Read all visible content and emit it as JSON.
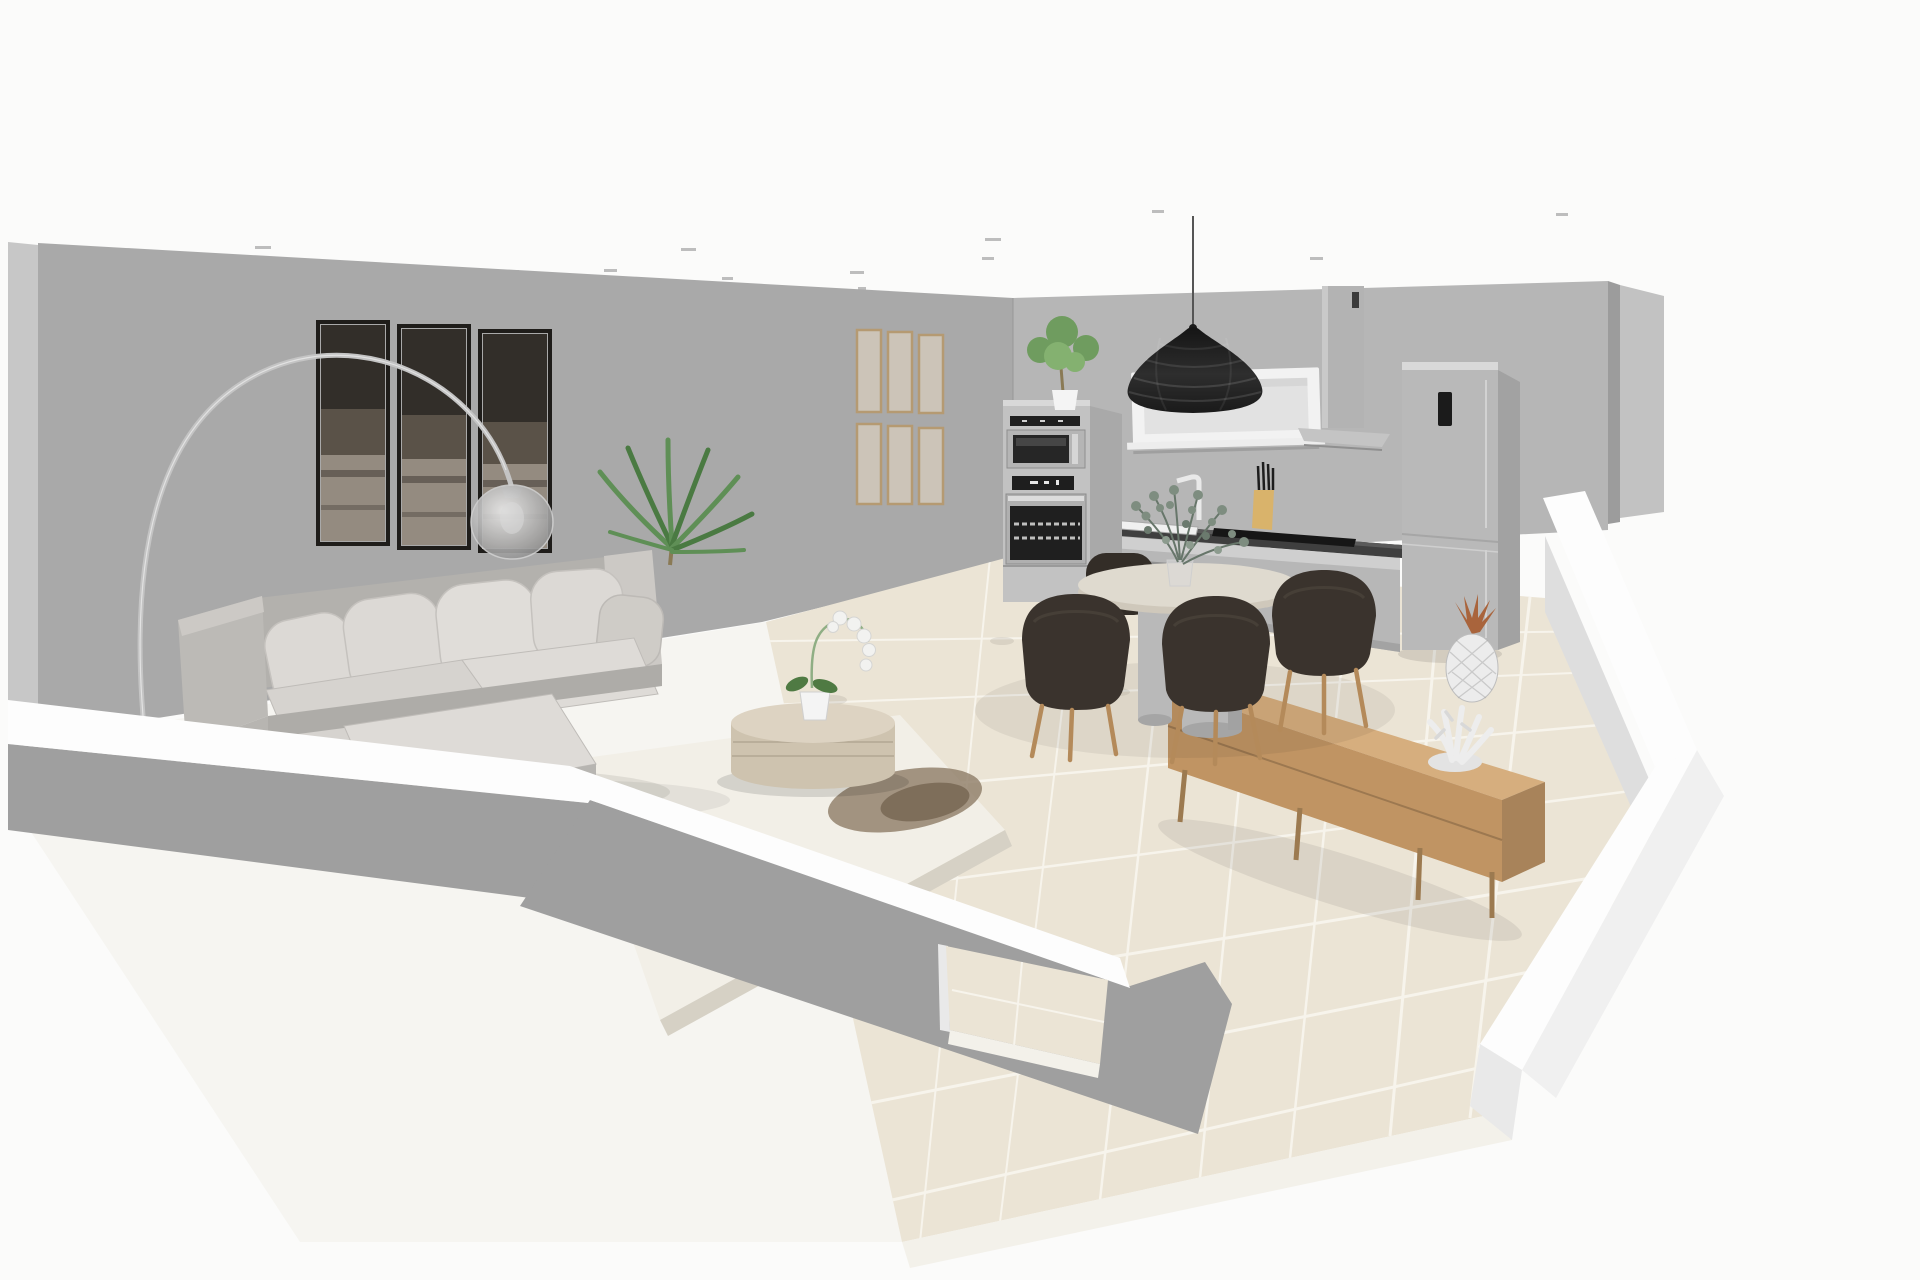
{
  "scene": {
    "view_label": "3D room plan view",
    "room_label": "Open plan living room and kitchen"
  },
  "palette": {
    "bg": "#fbfbfa",
    "wallMain": "#a9a9a9",
    "wallKitchen": "#b6b6b6",
    "wallEdgeLight": "#c7c7c7",
    "wallSideDark": "#9c9c9c",
    "wallFarLight": "#c2c2c2",
    "wallSeam": "#969696",
    "halfWallTop": "#fdfdfd",
    "halfWallFront": "#9f9f9f",
    "halfWallOuter": "#f0f0f0",
    "halfWallEnd": "#e9e9e9",
    "innerFace": "#dedede",
    "floorLiving": "#f6f5f1",
    "tile": "#ebe4d5",
    "grout": "#f7f4ec",
    "slabEdge": "#f3f1ea",
    "rug": "#f2efe7",
    "rugFringe": "#d6d1c5",
    "rugPatch": "#8d7c67",
    "rugPatchDark": "#6f5e4a",
    "sofaFrame": "#bcbab6",
    "sofaFrameDark": "#aeaca8",
    "sofaBack": "#b3b1ad",
    "sofaArmLight": "#ccc9c5",
    "sofaCushion": "#dcd9d5",
    "sofaCushionLight": "#e0ddd9",
    "sofaCushionDark": "#cfccc7",
    "sofaSeat": "#d6d3cf",
    "sofaChaise": "#dedbd7",
    "sofaFrontFace": "#b7b5b1",
    "artFrame": "#1f1d1a",
    "artTop": "#322e29",
    "artMid": "#5a5248",
    "artLow": "#948b80",
    "frameWood": "#b59a72",
    "frameInner": "#cdc5b8",
    "lampChrome": "#c4c4c4",
    "lampBase": "#d0d0d0",
    "lampCap": "#9a9a9a",
    "palmGreen": "#5f8f56",
    "palmGreenDark": "#4a7a42",
    "plantGreen": "#6f9c5f",
    "plantTrunk": "#8a7a55",
    "potWhite": "#f4f4f4",
    "drumTop": "#ddd3c2",
    "drumSide": "#cec3af",
    "drumBand": "#b9ae9a",
    "orchidWhite": "#f2f2f0",
    "orchidStem": "#8fae84",
    "leafGreen": "#4f7a43",
    "windowFrame": "#f2f2f2",
    "windowInner": "#e2e2e2",
    "windowSill": "#ededed",
    "hood": "#b3b3b3",
    "hoodCanopy": "#c4c4c4",
    "hoodSlot": "#3a3a3a",
    "steel": "#c2c2c2",
    "steelSide": "#a9a9a9",
    "steelTop": "#d8d8d8",
    "applianceBlack": "#1e1e1e",
    "applianceGlass": "#262626",
    "ovenGlass": "#1f1f1f",
    "ovenFrame": "#b0b0b0",
    "mwFrame": "#b5b5b5",
    "counterTop": "#3f3f3f",
    "cabinet": "#b7b7b7",
    "cabinetRail": "#cfcfcf",
    "cabinetPlinth": "#a3a3a3",
    "sinkWhite": "#f0f0f0",
    "hobBlack": "#161616",
    "knifeWood": "#d9b36b",
    "knifeDark": "#1d1d1d",
    "pendantDark": "#1c1c1c",
    "cord": "#555555",
    "tableTop": "#dfdacf",
    "tableRim": "#cfc8bb",
    "pedestal": "#b9b9b9",
    "chairDark": "#3a332d",
    "chairDark2": "#332d27",
    "chairSheen": "#4a423a",
    "legWood": "#b48a5a",
    "fridge": "#b9b9b9",
    "fridgeSide": "#a2a2a2",
    "fridgeTop": "#d9d9d9",
    "fridgePanel": "#1b1b1b",
    "fridgeSeam": "#a6a6a6",
    "sideboardTop": "#d6ae7e",
    "sideboardFront": "#c09463",
    "sideboardEnd": "#a8835a",
    "sideboardLeg": "#9c7a50",
    "pineapple": "#ececec",
    "pineappleLeaf": "#a9643c",
    "coral": "#ededed",
    "eucalyptus": "#7e8d80",
    "eucalyptusDark": "#67766a",
    "glassVase": "#d8d8d8",
    "ceilingLight": "#bdbdbd"
  },
  "objects": {
    "room": {
      "label": "open plan room"
    },
    "backWall": {
      "label": "back wall"
    },
    "kitchenWall": {
      "label": "kitchen wall"
    },
    "ceilingLights": {
      "label": "ceiling spotlights"
    },
    "wallArt": {
      "label": "triptych wall art"
    },
    "frameGrid": {
      "label": "gallery picture frames"
    },
    "arcLamp": {
      "label": "arc floor lamp"
    },
    "palm": {
      "label": "palm plant"
    },
    "sofa": {
      "label": "sectional sofa"
    },
    "rug": {
      "label": "area rug"
    },
    "coffeeTable": {
      "label": "round coffee table"
    },
    "orchid": {
      "label": "orchid in pot"
    },
    "tileFloor": {
      "label": "tiled floor"
    },
    "diningTable": {
      "label": "round dining table"
    },
    "diningChairs": {
      "label": "dining chairs"
    },
    "centerpiece": {
      "label": "eucalyptus centerpiece"
    },
    "pendant": {
      "label": "black pendant lamp"
    },
    "window": {
      "label": "window panel"
    },
    "hood": {
      "label": "range hood"
    },
    "ovenColumn": {
      "label": "oven and microwave column"
    },
    "ovenPlant": {
      "label": "potted plant on oven column"
    },
    "counter": {
      "label": "kitchen counter"
    },
    "sink": {
      "label": "sink"
    },
    "faucet": {
      "label": "faucet"
    },
    "hob": {
      "label": "cooktop"
    },
    "knifeBlock": {
      "label": "knife block"
    },
    "fridge": {
      "label": "refrigerator"
    },
    "sideboard": {
      "label": "wooden sideboard"
    },
    "pineapple": {
      "label": "pineapple ornament"
    },
    "coral": {
      "label": "coral ornament"
    },
    "halfWalls": {
      "label": "cutaway half walls"
    },
    "rightWall": {
      "label": "right cutaway wall"
    }
  }
}
